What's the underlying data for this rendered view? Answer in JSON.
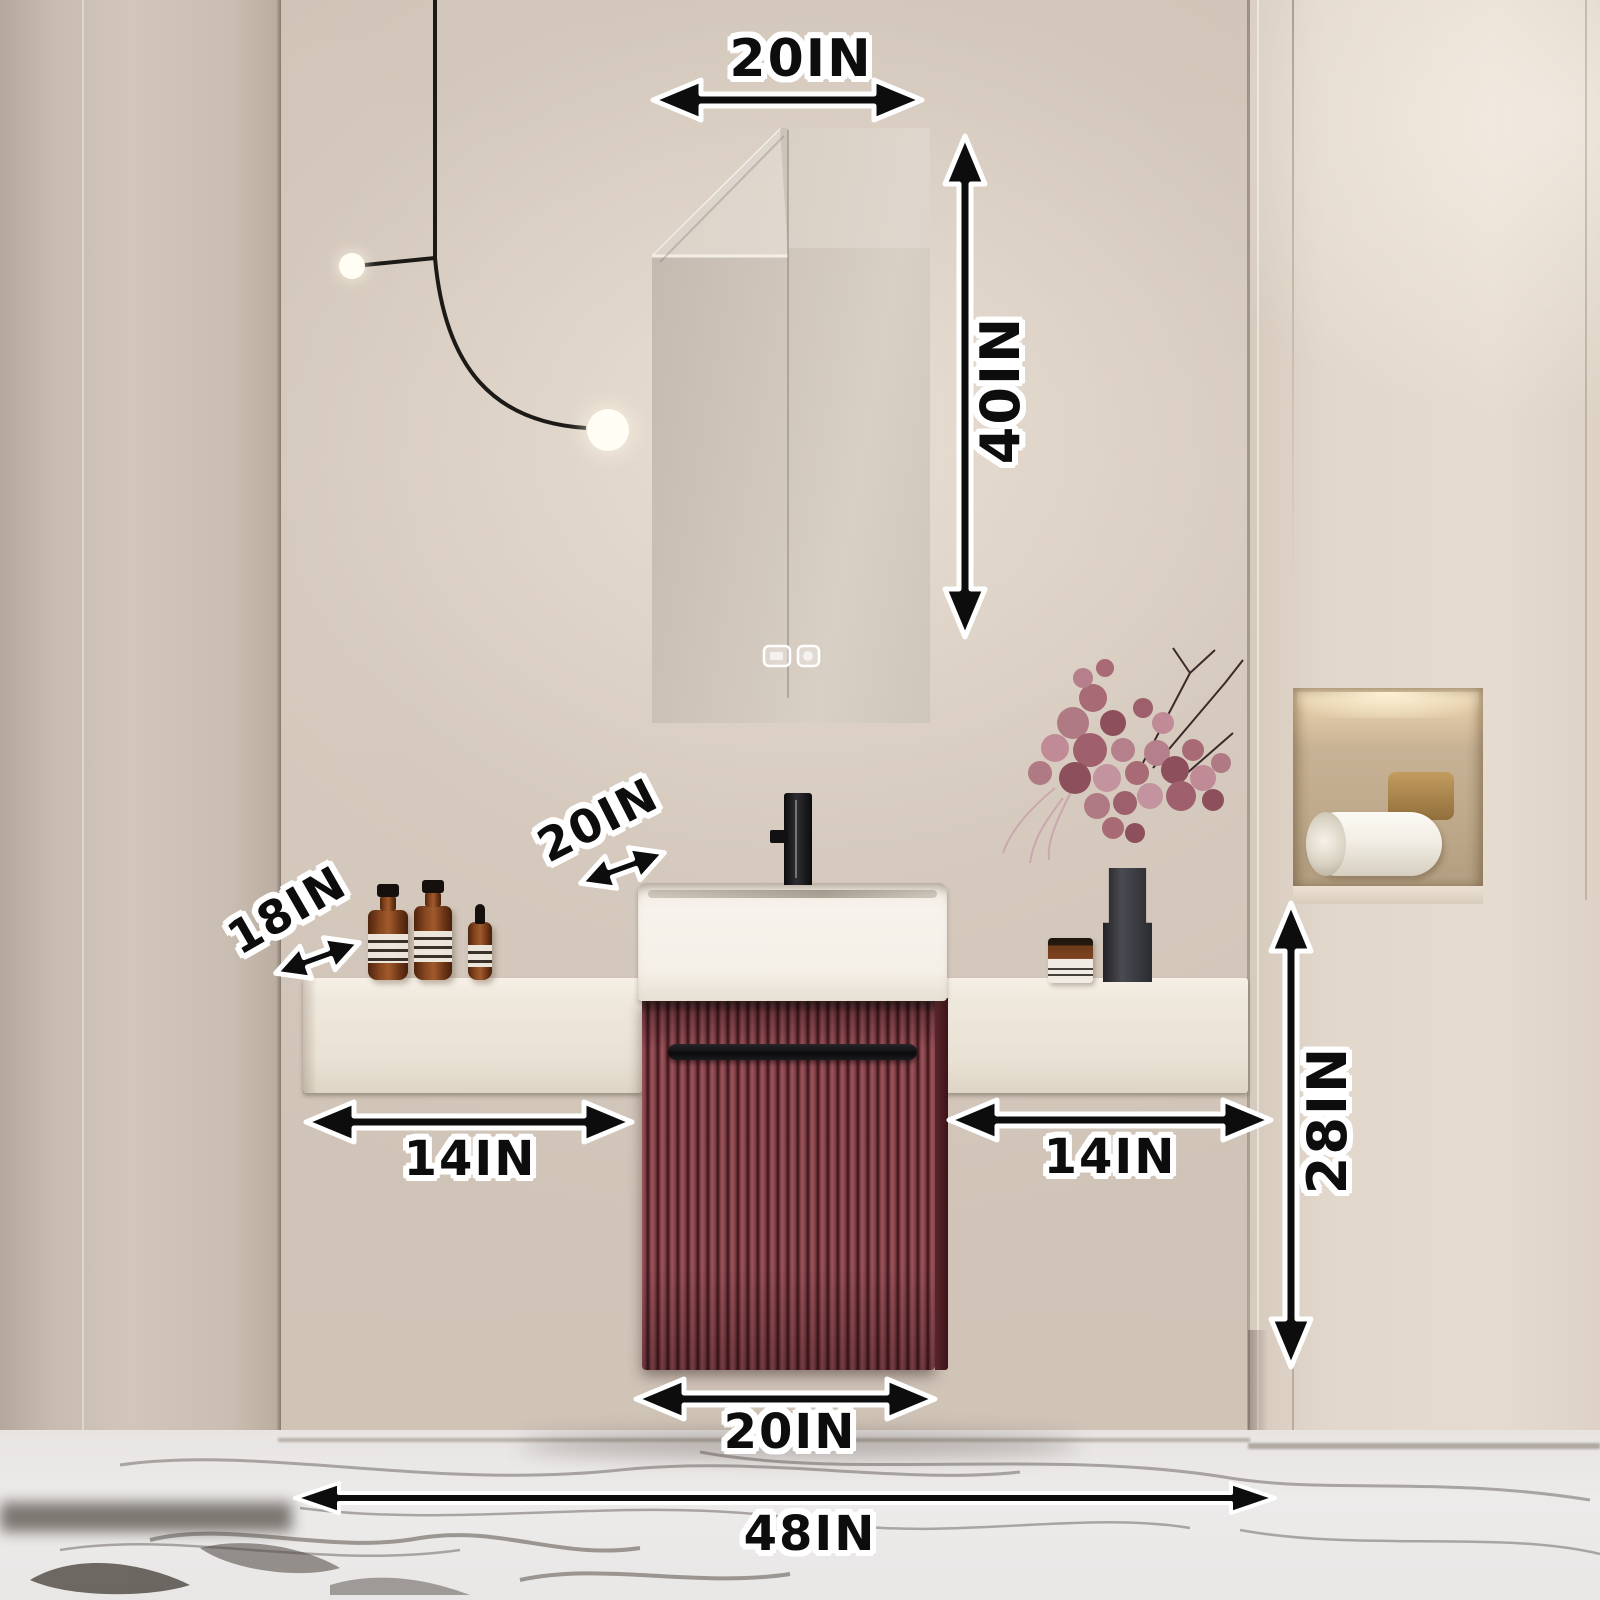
{
  "meta": {
    "type": "product-dimension-photo",
    "subject": "Wall-hung fluted red bathroom vanity set with LED mirror"
  },
  "annotations": {
    "mirror_width": "20IN",
    "mirror_height": "40IN",
    "sink_depth": "20IN",
    "countertop_depth": "18IN",
    "left_counter_width": "14IN",
    "right_counter_width": "14IN",
    "under_counter_height": "28IN",
    "cabinet_width": "20IN",
    "overall_width": "48IN"
  },
  "colors": {
    "annotation_text": "#0d0d0d",
    "annotation_outline": "#ffffff",
    "wall_beige": "#d2c7bb",
    "cabinet_red": "#7c3a41",
    "countertop_cream": "#efe8dc",
    "floor_marble": "#eae8e6",
    "led_glow": "#fff6e6"
  },
  "scene_objects": [
    "led-mirror",
    "mirror-touch-buttons",
    "pendant-light",
    "floating-countertop",
    "vessel-sink",
    "black-faucet",
    "fluted-red-vanity-cabinet",
    "cabinet-handle",
    "amber-bottles",
    "dried-flower-vase",
    "amber-jar",
    "wall-niche-with-towel",
    "marble-floor"
  ]
}
